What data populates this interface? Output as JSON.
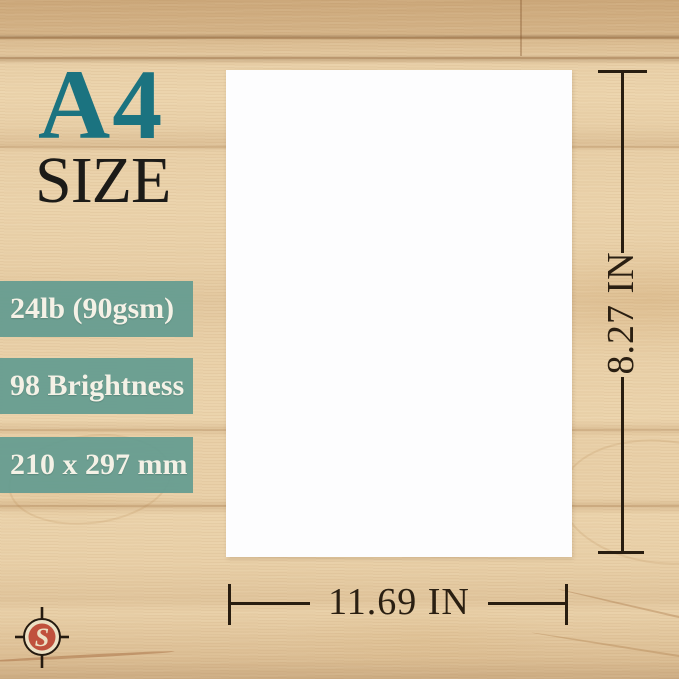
{
  "heading": {
    "title": "A4",
    "subtitle": "SIZE"
  },
  "badges": {
    "weight": "24lb (90gsm)",
    "brightness": "98 Brightness",
    "size_mm": "210 x 297 mm"
  },
  "dimensions": {
    "height_label": "8.27 IN",
    "width_label": "11.69 IN"
  },
  "logo": {
    "monogram": "S"
  },
  "colors": {
    "heading_teal": "#1b7380",
    "badge_teal": "#659c91",
    "badge_text": "#f4f1e6",
    "ink": "#281d10",
    "wood_base": "#e9d0a8",
    "paper_white": "#fdfdfe",
    "logo_red": "#c0513d",
    "logo_cream": "#ece0c4"
  }
}
